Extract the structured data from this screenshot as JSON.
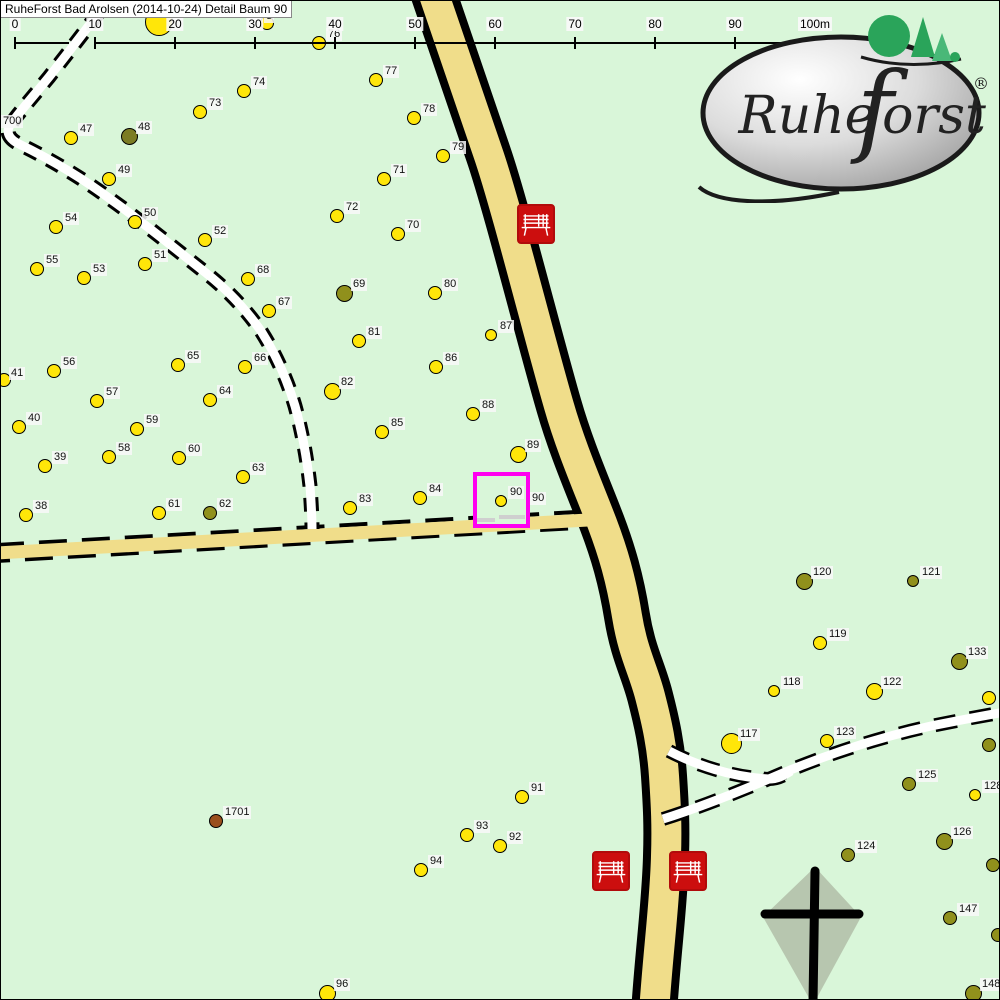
{
  "title": "RuheForst Bad Arolsen (2014-10-24) Detail  Baum 90",
  "scale_bar": {
    "unit_labels": [
      "0",
      "10",
      "20",
      "30",
      "40",
      "50",
      "60",
      "70",
      "80",
      "90",
      "100m"
    ]
  },
  "logo": {
    "text_pre": "Ruhe",
    "text_f": "f",
    "text_post": "orst",
    "registered": "®"
  },
  "colors": {
    "background": "#d9f6d9",
    "road_yellow": "#f0dd8a",
    "tree_yellow": "#ffe609",
    "tree_olive": "#90901c",
    "tree_dark_olive": "#7c7c24",
    "tree_brown": "#9a4f1d",
    "bench_red": "#cc0e0e",
    "highlight_magenta": "#ff00f0",
    "cross_fill": "#b7c6af",
    "logo_tree_green": "#2aa45a"
  },
  "highlight_box": {
    "x": 474,
    "y": 473,
    "w": 53,
    "h": 52,
    "tree": "90"
  },
  "cross": {
    "x": 812,
    "y": 912
  },
  "benches": [
    {
      "x": 516,
      "y": 203
    },
    {
      "x": 591,
      "y": 850
    },
    {
      "x": 668,
      "y": 850
    }
  ],
  "extra_labels": [
    {
      "text": "700",
      "x": 0,
      "y": 114
    },
    {
      "text": "3",
      "x": 263,
      "y": 9
    },
    {
      "text": "90",
      "x": 529,
      "y": 491
    }
  ],
  "trees": [
    {
      "n": "",
      "x": 157,
      "y": 20,
      "c": "y",
      "s": "xxl"
    },
    {
      "n": "",
      "x": 265,
      "y": 21,
      "c": "y",
      "s": "m"
    },
    {
      "n": "76",
      "x": 317,
      "y": 41,
      "c": "y",
      "s": "m"
    },
    {
      "n": "77",
      "x": 374,
      "y": 78,
      "c": "y",
      "s": "m"
    },
    {
      "n": "74",
      "x": 242,
      "y": 89,
      "c": "y",
      "s": "m"
    },
    {
      "n": "73",
      "x": 198,
      "y": 110,
      "c": "y",
      "s": "m"
    },
    {
      "n": "78",
      "x": 412,
      "y": 116,
      "c": "y",
      "s": "m"
    },
    {
      "n": "79",
      "x": 441,
      "y": 154,
      "c": "y",
      "s": "m"
    },
    {
      "n": "47",
      "x": 69,
      "y": 136,
      "c": "y",
      "s": "m"
    },
    {
      "n": "48",
      "x": 127,
      "y": 134,
      "c": "o2",
      "s": "l"
    },
    {
      "n": "49",
      "x": 107,
      "y": 177,
      "c": "y",
      "s": "m"
    },
    {
      "n": "71",
      "x": 382,
      "y": 177,
      "c": "y",
      "s": "m"
    },
    {
      "n": "72",
      "x": 335,
      "y": 214,
      "c": "y",
      "s": "m"
    },
    {
      "n": "50",
      "x": 133,
      "y": 220,
      "c": "y",
      "s": "m"
    },
    {
      "n": "70",
      "x": 396,
      "y": 232,
      "c": "y",
      "s": "m"
    },
    {
      "n": "54",
      "x": 54,
      "y": 225,
      "c": "y",
      "s": "m"
    },
    {
      "n": "52",
      "x": 203,
      "y": 238,
      "c": "y",
      "s": "m"
    },
    {
      "n": "51",
      "x": 143,
      "y": 262,
      "c": "y",
      "s": "m"
    },
    {
      "n": "55",
      "x": 35,
      "y": 267,
      "c": "y",
      "s": "m"
    },
    {
      "n": "53",
      "x": 82,
      "y": 276,
      "c": "y",
      "s": "m"
    },
    {
      "n": "68",
      "x": 246,
      "y": 277,
      "c": "y",
      "s": "m"
    },
    {
      "n": "69",
      "x": 342,
      "y": 291,
      "c": "o",
      "s": "l"
    },
    {
      "n": "80",
      "x": 433,
      "y": 291,
      "c": "y",
      "s": "m"
    },
    {
      "n": "67",
      "x": 267,
      "y": 309,
      "c": "y",
      "s": "m"
    },
    {
      "n": "87",
      "x": 489,
      "y": 333,
      "c": "y",
      "s": "s"
    },
    {
      "n": "81",
      "x": 357,
      "y": 339,
      "c": "y",
      "s": "m"
    },
    {
      "n": "86",
      "x": 434,
      "y": 365,
      "c": "y",
      "s": "m"
    },
    {
      "n": "66",
      "x": 243,
      "y": 365,
      "c": "y",
      "s": "m"
    },
    {
      "n": "65",
      "x": 176,
      "y": 363,
      "c": "y",
      "s": "m"
    },
    {
      "n": "56",
      "x": 52,
      "y": 369,
      "c": "y",
      "s": "m"
    },
    {
      "n": "41",
      "x": 2,
      "y": 378,
      "c": "y",
      "s": "m",
      "lx": 8,
      "ly": 366
    },
    {
      "n": "57",
      "x": 95,
      "y": 399,
      "c": "y",
      "s": "m"
    },
    {
      "n": "64",
      "x": 208,
      "y": 398,
      "c": "y",
      "s": "m"
    },
    {
      "n": "40",
      "x": 17,
      "y": 425,
      "c": "y",
      "s": "m"
    },
    {
      "n": "59",
      "x": 135,
      "y": 427,
      "c": "y",
      "s": "m"
    },
    {
      "n": "82",
      "x": 330,
      "y": 389,
      "c": "y",
      "s": "l"
    },
    {
      "n": "88",
      "x": 471,
      "y": 412,
      "c": "y",
      "s": "m"
    },
    {
      "n": "85",
      "x": 380,
      "y": 430,
      "c": "y",
      "s": "m"
    },
    {
      "n": "58",
      "x": 107,
      "y": 455,
      "c": "y",
      "s": "m"
    },
    {
      "n": "60",
      "x": 177,
      "y": 456,
      "c": "y",
      "s": "m"
    },
    {
      "n": "39",
      "x": 43,
      "y": 464,
      "c": "y",
      "s": "m"
    },
    {
      "n": "63",
      "x": 241,
      "y": 475,
      "c": "y",
      "s": "m"
    },
    {
      "n": "89",
      "x": 516,
      "y": 452,
      "c": "y",
      "s": "l"
    },
    {
      "n": "84",
      "x": 418,
      "y": 496,
      "c": "y",
      "s": "m"
    },
    {
      "n": "83",
      "x": 348,
      "y": 506,
      "c": "y",
      "s": "m"
    },
    {
      "n": "90",
      "x": 499,
      "y": 499,
      "c": "y",
      "s": "s"
    },
    {
      "n": "38",
      "x": 24,
      "y": 513,
      "c": "y",
      "s": "m"
    },
    {
      "n": "61",
      "x": 157,
      "y": 511,
      "c": "y",
      "s": "m"
    },
    {
      "n": "62",
      "x": 208,
      "y": 511,
      "c": "o",
      "s": "m"
    },
    {
      "n": "120",
      "x": 802,
      "y": 579,
      "c": "o",
      "s": "l"
    },
    {
      "n": "121",
      "x": 911,
      "y": 579,
      "c": "o",
      "s": "s"
    },
    {
      "n": "119",
      "x": 818,
      "y": 641,
      "c": "y",
      "s": "m"
    },
    {
      "n": "133",
      "x": 957,
      "y": 659,
      "c": "o",
      "s": "l"
    },
    {
      "n": "118",
      "x": 772,
      "y": 689,
      "c": "y",
      "s": "s"
    },
    {
      "n": "122",
      "x": 872,
      "y": 689,
      "c": "y",
      "s": "l"
    },
    {
      "n": "",
      "x": 987,
      "y": 696,
      "c": "y",
      "s": "m"
    },
    {
      "n": "117",
      "x": 729,
      "y": 741,
      "c": "y",
      "s": "xl"
    },
    {
      "n": "123",
      "x": 825,
      "y": 739,
      "c": "y",
      "s": "m"
    },
    {
      "n": "",
      "x": 987,
      "y": 743,
      "c": "o",
      "s": "m"
    },
    {
      "n": "125",
      "x": 907,
      "y": 782,
      "c": "o",
      "s": "m"
    },
    {
      "n": "128",
      "x": 973,
      "y": 793,
      "c": "y",
      "s": "s"
    },
    {
      "n": "126",
      "x": 942,
      "y": 839,
      "c": "o",
      "s": "l"
    },
    {
      "n": "",
      "x": 991,
      "y": 863,
      "c": "o",
      "s": "m"
    },
    {
      "n": "124",
      "x": 846,
      "y": 853,
      "c": "o",
      "s": "m"
    },
    {
      "n": "147",
      "x": 948,
      "y": 916,
      "c": "o",
      "s": "m"
    },
    {
      "n": "",
      "x": 996,
      "y": 933,
      "c": "o",
      "s": "m"
    },
    {
      "n": "148",
      "x": 971,
      "y": 991,
      "c": "o",
      "s": "l"
    },
    {
      "n": "91",
      "x": 520,
      "y": 795,
      "c": "y",
      "s": "m"
    },
    {
      "n": "93",
      "x": 465,
      "y": 833,
      "c": "y",
      "s": "m"
    },
    {
      "n": "92",
      "x": 498,
      "y": 844,
      "c": "y",
      "s": "m"
    },
    {
      "n": "94",
      "x": 419,
      "y": 868,
      "c": "y",
      "s": "m"
    },
    {
      "n": "96",
      "x": 325,
      "y": 991,
      "c": "y",
      "s": "l"
    },
    {
      "n": "1701",
      "x": 214,
      "y": 819,
      "c": "b",
      "s": "m"
    }
  ]
}
